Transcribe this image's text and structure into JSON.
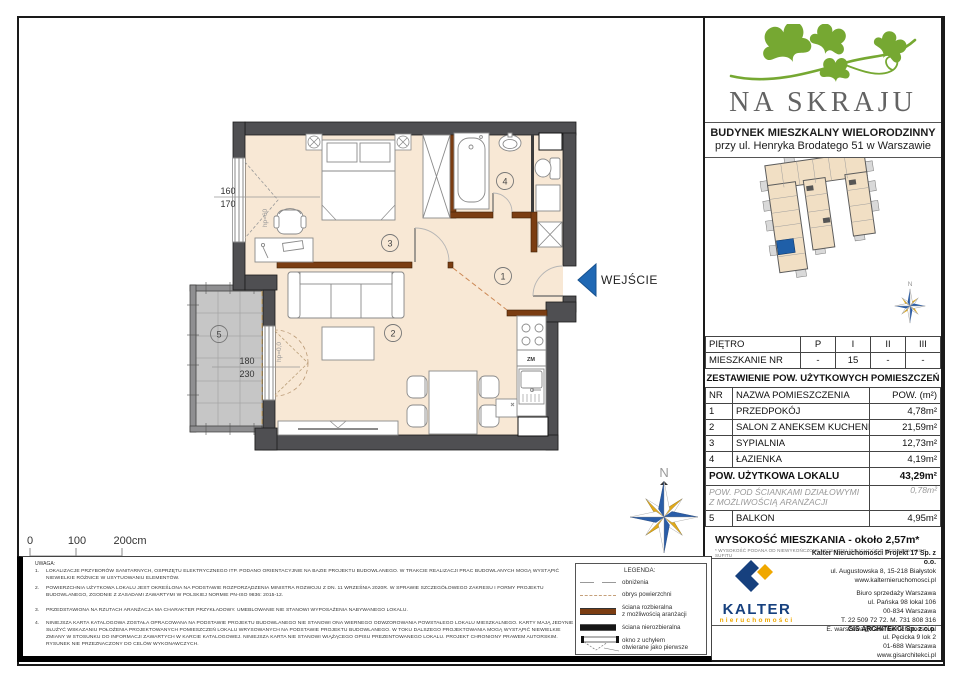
{
  "plan": {
    "entrance_label": "WEJŚCIE",
    "room_numbers": [
      "1",
      "2",
      "3",
      "4",
      "5"
    ],
    "dims": {
      "w1_top": "160",
      "w1_bot": "170",
      "w2_top": "180",
      "w2_bot": "230",
      "hp_window": "hp=60",
      "hp_balcony": "hp=0,0"
    },
    "kitchen_zm": "ZM"
  },
  "scale_bar": {
    "t0": "0",
    "t100": "100",
    "t200": "200cm"
  },
  "compass": {
    "north": "N"
  },
  "site_plan": {
    "north": "N"
  },
  "brand": {
    "name": "NA SKRAJU"
  },
  "building": {
    "line1": "BUDYNEK MIESZKALNY WIELORODZINNY",
    "line2": "przy ul. Henryka Brodatego 51 w Warszawie"
  },
  "floor_table": {
    "floor_label": "PIĘTRO",
    "floor_values": [
      "P",
      "I",
      "II",
      "III"
    ],
    "apt_label": "MIESZKANIE NR",
    "apt_values": [
      "-",
      "15",
      "-",
      "-"
    ]
  },
  "area_table": {
    "title": "ZESTAWIENIE POW. UŻYTKOWYCH POMIESZCZEŃ",
    "col_nr": "NR",
    "col_name": "NAZWA POMIESZCZENIA",
    "col_area": "POW. (m²)",
    "rows": [
      {
        "nr": "1",
        "name": "PRZEDPOKÓJ",
        "area": "4,78m²"
      },
      {
        "nr": "2",
        "name": "SALON Z ANEKSEM KUCHENNYM",
        "area": "21,59m²"
      },
      {
        "nr": "3",
        "name": "SYPIALNIA",
        "area": "12,73m²"
      },
      {
        "nr": "4",
        "name": "ŁAZIENKA",
        "area": "4,19m²"
      }
    ],
    "total_label": "POW. UŻYTKOWA LOKALU",
    "total_value": "43,29m²",
    "partition_line1": "POW. POD ŚCIANKAMI DZIAŁOWYMI",
    "partition_line2": "Z MOŻLIWOŚCIĄ ARANŻACJI",
    "partition_value": "0,78m²",
    "balcony_nr": "5",
    "balcony_label": "BALKON",
    "balcony_value": "4,95m²"
  },
  "height": {
    "line": "WYSOKOŚĆ MIESZKANIA - około 2,57m*",
    "note": "* WYSOKOŚĆ PODANA OD NIEWYKOŃCZONEJ POSADZKI (SZLICHTY) DO OTYNKOWANEGO SUFITU"
  },
  "legend": {
    "title": "LEGENDA:",
    "items": [
      {
        "label1": "obniżenia",
        "label2": ""
      },
      {
        "label1": "obrys powierzchni",
        "label2": ""
      },
      {
        "label1": "ściana rozbieralna",
        "label2": "z możliwością aranżacji"
      },
      {
        "label1": "ściana nierozbieralna",
        "label2": ""
      },
      {
        "label1": "okno z uchyłem",
        "label2": "otwierane jako pierwsze"
      }
    ]
  },
  "notes": {
    "title": "UWAGA:",
    "items": [
      {
        "num": "1.",
        "text": "Lokalizacje przyborów sanitarnych, osprzętu elektrycznego itp. podano orientacyjnie na bazie projektu budowlanego. W trakcie realizacji prac budowlanych mogą wystąpić niewielkie różnice w usytuowaniu elementów."
      },
      {
        "num": "2.",
        "text": "Powierzchnia użytkowa lokalu jest określona na podstawie Rozporządzenia Ministra Rozwoju z dn. 11 września 2020r. w sprawie szczegółowego zakresu i formy projektu budowlanego, zgodnie z zasadami zawartymi w polskiej normie PN-ISO 9836: 2015-12."
      },
      {
        "num": "3.",
        "text": "Przedstawiona na rzutach aranżacja ma charakter przykładowy. Umeblowanie nie stanowi wyposażenia nabywanego lokalu."
      },
      {
        "num": "4.",
        "text": "Niniejsza karta katalogowa została opracowana na podstawie projektu budowlanego nie stanowi ona wiernego odwzorowania powstałego lokalu mieszkalnego. Karty mają jedynie służyć wskazaniu położenia projektowanych pomieszczeń lokalu wrysowanych na podstawie projektu budowlanego. W toku dalszego projektowania mogą wystąpić niewielkie zmiany w stosunku do informacji zawartych w karcie katalogowej. Niniejsza karta nie stanowi wiążącego opisu prezentowanego lokalu. Projekt chroniony prawem autorskim. Rysunek nie przeznaczony do celów wykonawczych."
      }
    ]
  },
  "footer": {
    "kalter": {
      "name": "KALTER",
      "sub": "nieruchomości"
    },
    "company": [
      "Kalter Nieruchomości Projekt 17 Sp. z o.o.",
      "ul. Augustowska 8, 15-218 Białystok",
      "www.kalternieruchomosci.pl"
    ],
    "office": [
      "Biuro sprzedaży Warszawa",
      "ul. Pańska 98 lokal 106",
      "00-834 Warszawa",
      "T. 22 509 72 72. M. 731 808 316",
      "E. warszawa@kalternieruchomosci.pl"
    ],
    "architect": [
      "GIS ARCHITEKCI Sp. z o.o.",
      "ul. Pęcicka 9 lok 2",
      "01-688 Warszawa",
      "www.gisarchitekci.pl"
    ]
  },
  "colors": {
    "logo_green": "#76a832",
    "brand_gray": "#636363",
    "kalter_blue": "#16407e",
    "kalter_yellow": "#f0a800",
    "wall_dark": "#4f4f52",
    "wall_brown": "#7b3d12",
    "floor_fill": "#f8e8d5",
    "balcony_tile": "#c6c6c6",
    "entrance_blue": "#1f68b4",
    "compass_blue": "#2a5da8",
    "compass_yellow": "#e0a91c",
    "highlight_unit": "#1f5fa8"
  }
}
